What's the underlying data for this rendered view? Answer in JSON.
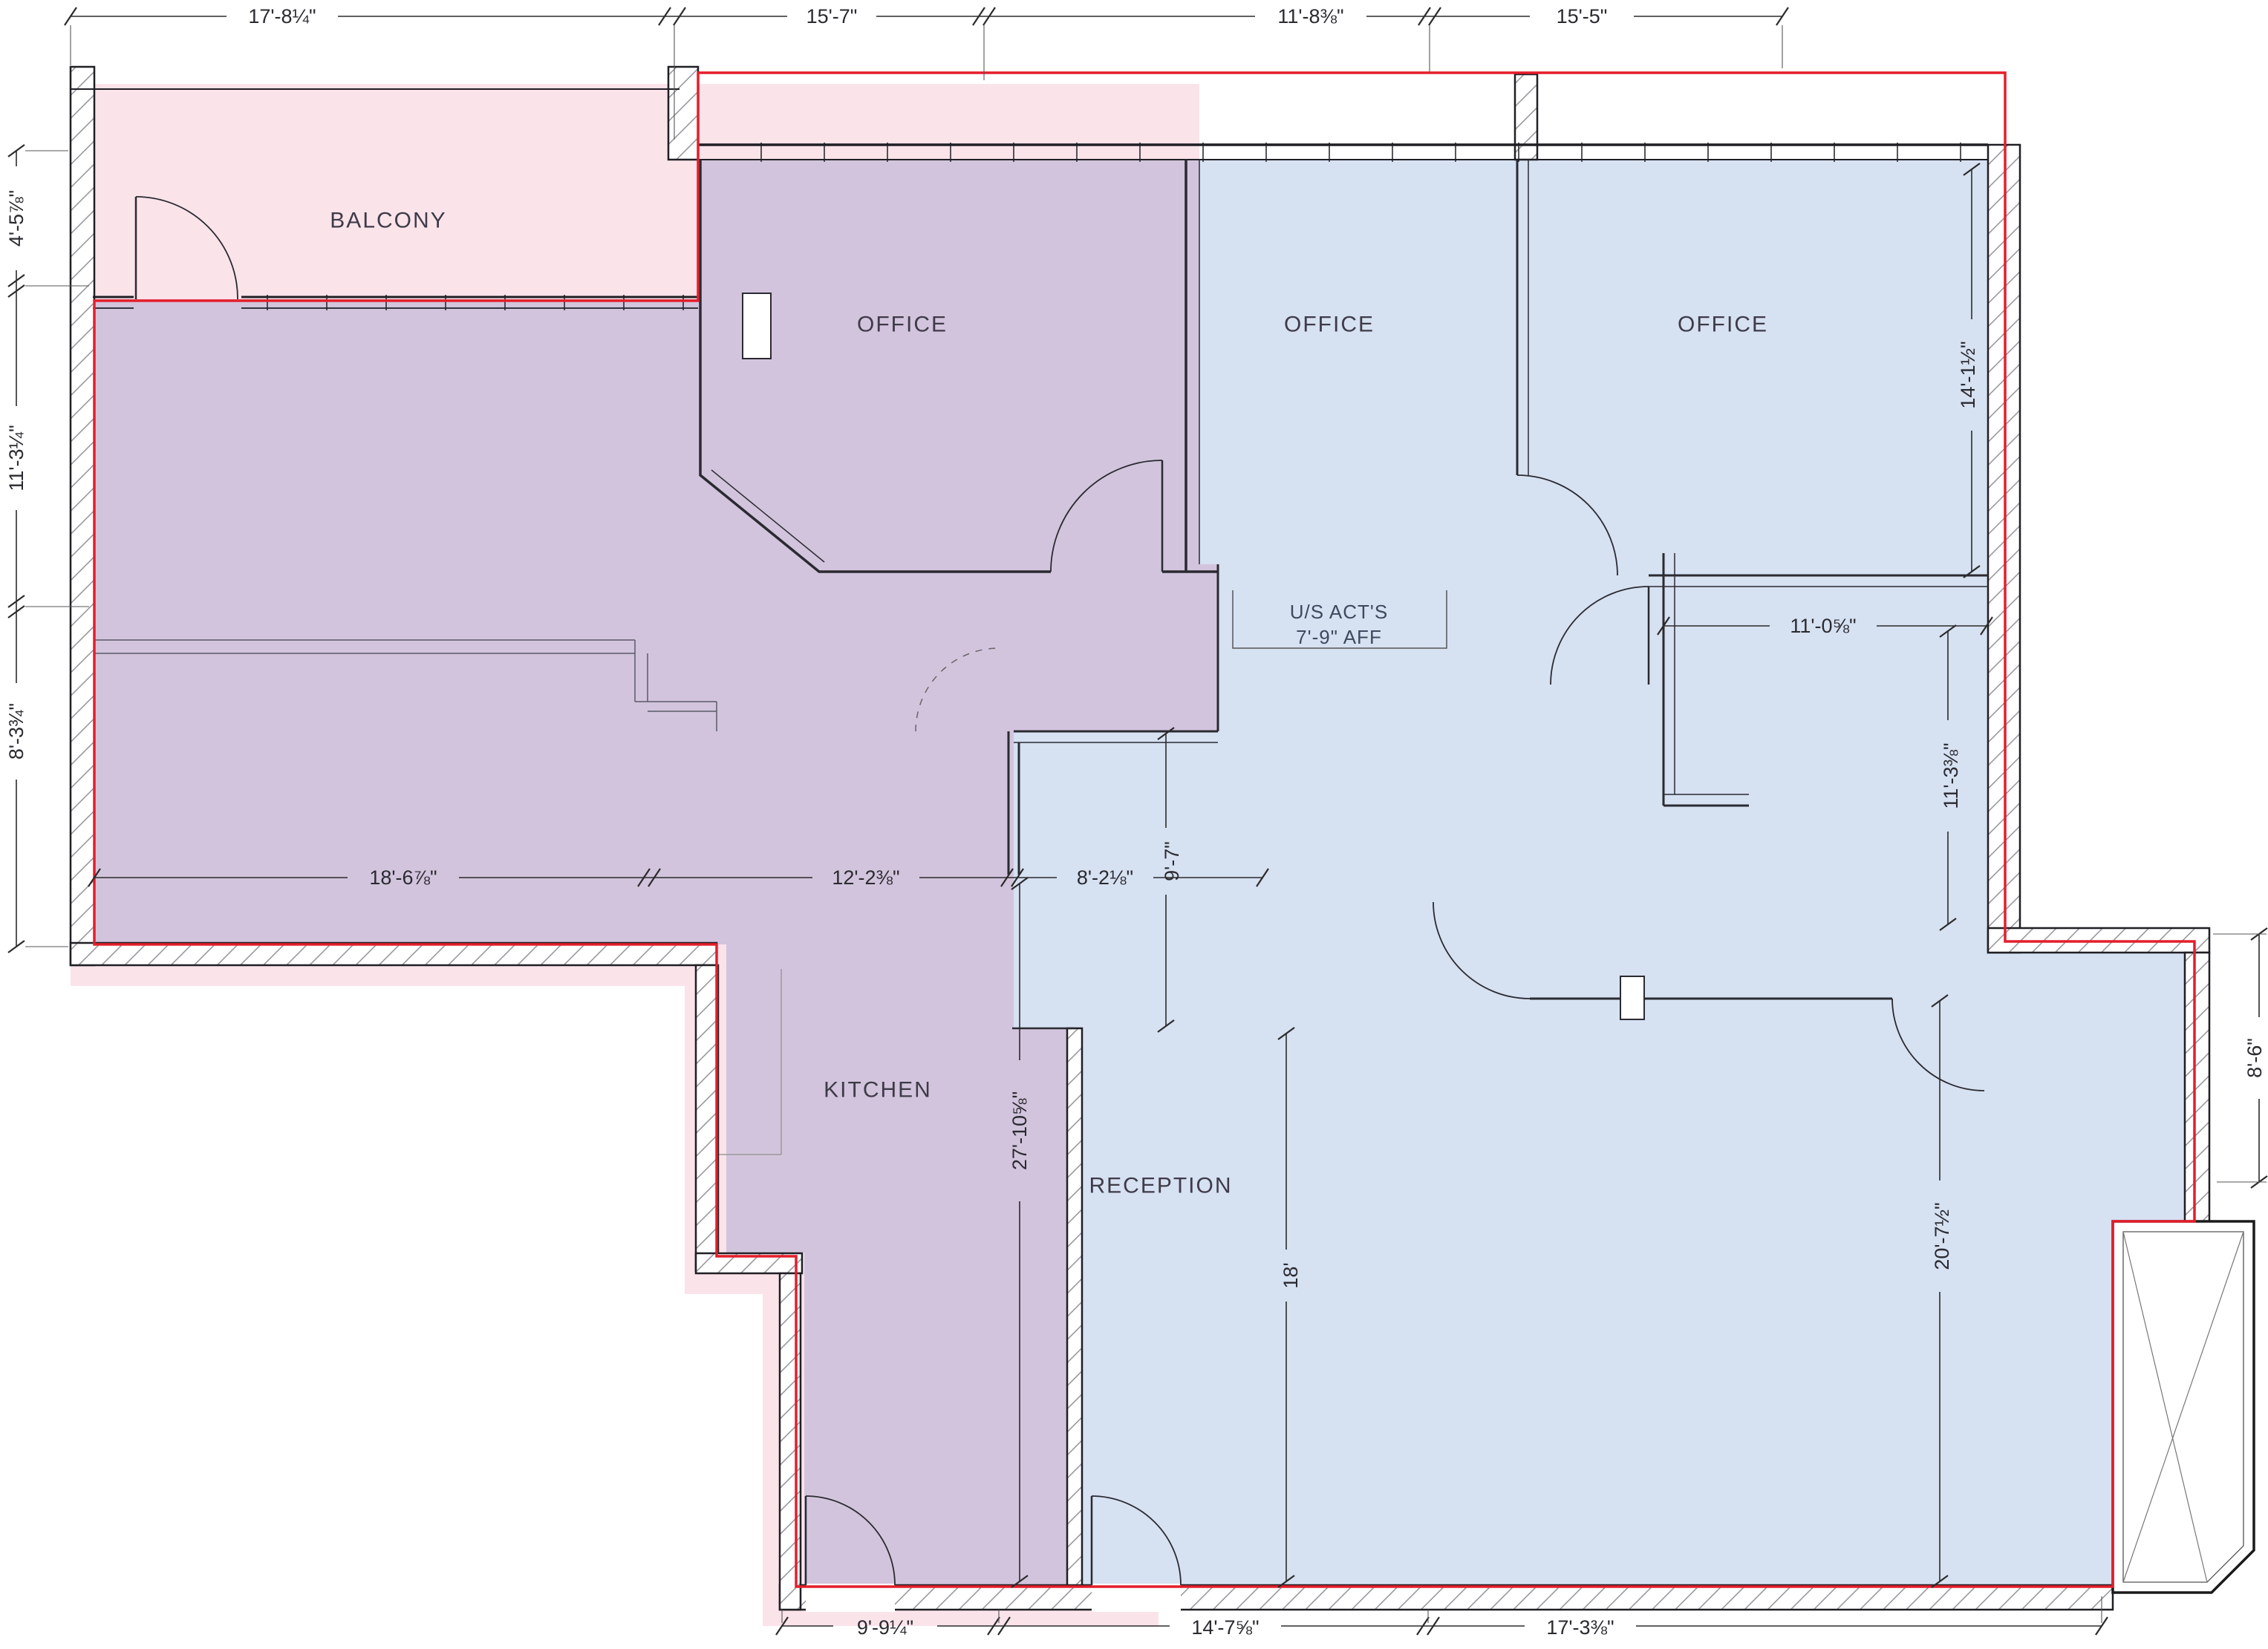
{
  "plan": {
    "rooms": {
      "balcony": "BALCONY",
      "office_a": "OFFICE",
      "office_b": "OFFICE",
      "office_c": "OFFICE",
      "kitchen": "KITCHEN",
      "reception": "RECEPTION"
    },
    "note": {
      "line1": "U/S ACT'S",
      "line2": "7'-9\" AFF"
    },
    "dims": {
      "top": [
        "17'-8¼\"",
        "15'-7\"",
        "11'-8⅜\"",
        "15'-5\""
      ],
      "left": [
        "4'-5⅞\"",
        "11'-3¼\"",
        "8'-3¾\""
      ],
      "bottom": [
        "9'-9¼\"",
        "14'-7⅝\"",
        "17'-3⅜\""
      ],
      "mid": [
        "18'-6⅞\"",
        "12'-2⅜\"",
        "8'-2⅛\""
      ],
      "right_h": "11'-0⅝\"",
      "v_9_7": "9'-7\"",
      "v_27_10": "27'-10⅝\"",
      "v_18": "18'",
      "v_14_1": "14'-1½\"",
      "v_11_3": "11'-3⅜\"",
      "v_8_6": "8'-6\"",
      "v_20_7": "20'-7½\""
    },
    "colors": {
      "pink": "#fbe3ea",
      "purple": "#d3c4dd",
      "blue": "#d6e1f2",
      "demise_red": "#e41e2b"
    }
  }
}
